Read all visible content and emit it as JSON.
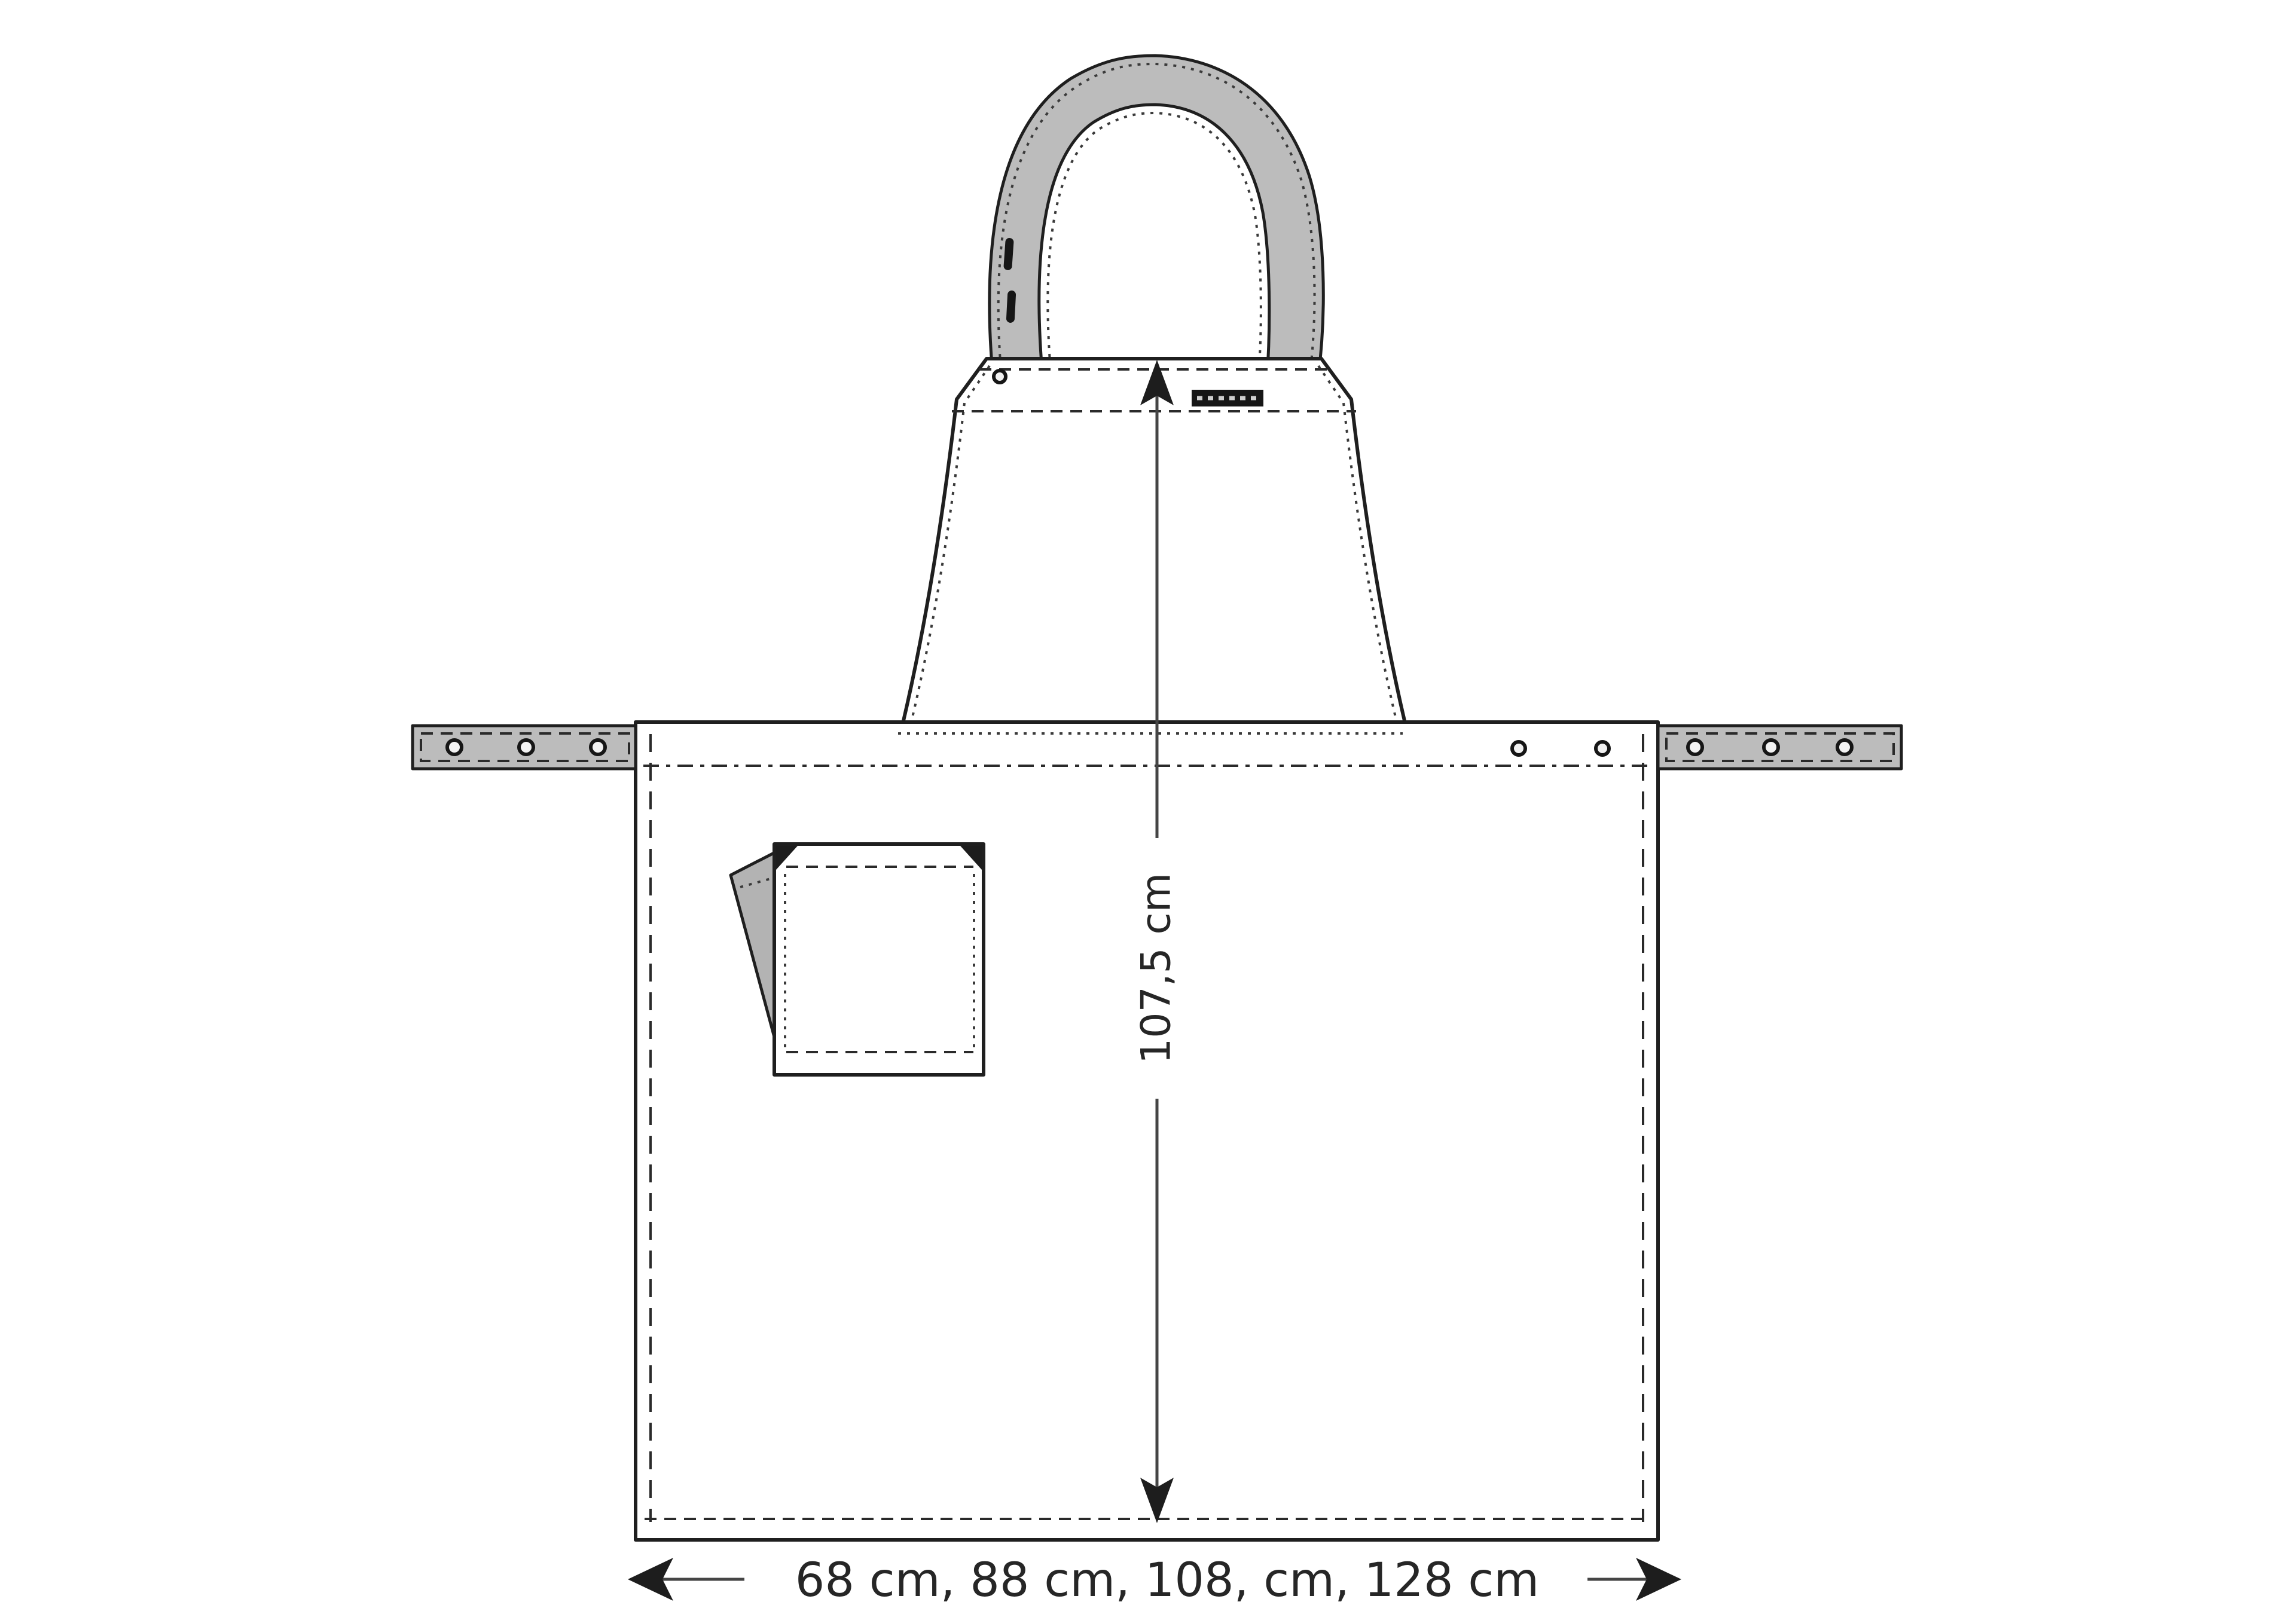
{
  "drawing": {
    "subject": "apron-technical-drawing",
    "parts": [
      "neck-strap",
      "strap-buttonholes",
      "bib-panel",
      "bib-rivet",
      "brand-label",
      "waist-seam",
      "left-waist-tie",
      "right-waist-tie",
      "tie-rivets",
      "skirt-panel",
      "patch-pocket",
      "pocket-flap",
      "skirt-rivets"
    ]
  },
  "dimensions": {
    "height": {
      "label": "107,5 cm"
    },
    "width": {
      "label": "68 cm, 88 cm, 108, cm, 128 cm"
    }
  },
  "colors": {
    "outline": "#1f1f1f",
    "fabric": "#ffffff",
    "strap": "#bcbcbc",
    "flap": "#b3b3b3",
    "dimension_line": "#454545",
    "text": "#262626",
    "label_tag": "#161616"
  }
}
